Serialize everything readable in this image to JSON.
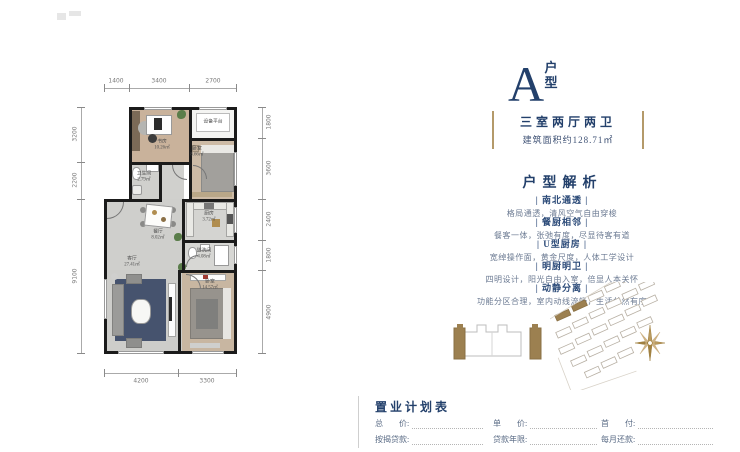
{
  "colors": {
    "navy": "#23406b",
    "gold": "#a98d5f",
    "wall": "#1b1b1b"
  },
  "title": {
    "letter": "A",
    "suffix": "户型"
  },
  "summary": {
    "layout": "三室两厅两卫",
    "area": "建筑面积约128.71㎡"
  },
  "analysis": {
    "heading": "户型解析",
    "items": [
      {
        "title": "| 南北通透 |",
        "desc": "格局通透，清风空气自由穿梭"
      },
      {
        "title": "| 餐厨相邻 |",
        "desc": "餐客一体，张弛有度，尽显待客有道"
      },
      {
        "title": "| U型厨房 |",
        "desc": "宽绰操作面，黄金尺度，人体工学设计"
      },
      {
        "title": "| 明厨明卫 |",
        "desc": "四明设计，阳光自由入室，倍显人本关怀"
      },
      {
        "title": "| 动静分离 |",
        "desc": "功能分区合理，室内动线流畅，生活井然有序"
      }
    ]
  },
  "plan": {
    "rooms": {
      "study": {
        "name": "书房",
        "area": "10.26㎡"
      },
      "platform": {
        "name": "设备平台",
        "area": ""
      },
      "bedroom2": {
        "name": "卧室",
        "area": "8.66㎡"
      },
      "bath1": {
        "name": "卫生间",
        "area": "2.79㎡"
      },
      "dining": {
        "name": "餐厅",
        "area": "8.02㎡"
      },
      "kitchen": {
        "name": "厨房",
        "area": "3.72㎡"
      },
      "bath2": {
        "name": "盥洗间",
        "area": "4.08㎡"
      },
      "living": {
        "name": "客厅",
        "area": "27.41㎡"
      },
      "master": {
        "name": "卧室",
        "area": "14.57㎡"
      }
    },
    "dims": {
      "top": [
        "1400",
        "3400",
        "2700"
      ],
      "left": [
        "3200",
        "2200",
        "9100"
      ],
      "right": [
        "1800",
        "3600",
        "2400",
        "1800",
        "4900"
      ],
      "bottom": [
        "4200",
        "3300"
      ]
    }
  },
  "purchase": {
    "heading": "置业计划表",
    "rows": [
      [
        "总　　价:",
        "单　　价:",
        "首　　付:"
      ],
      [
        "按揭贷款:",
        "贷款年限:",
        "每月还款:"
      ]
    ]
  }
}
